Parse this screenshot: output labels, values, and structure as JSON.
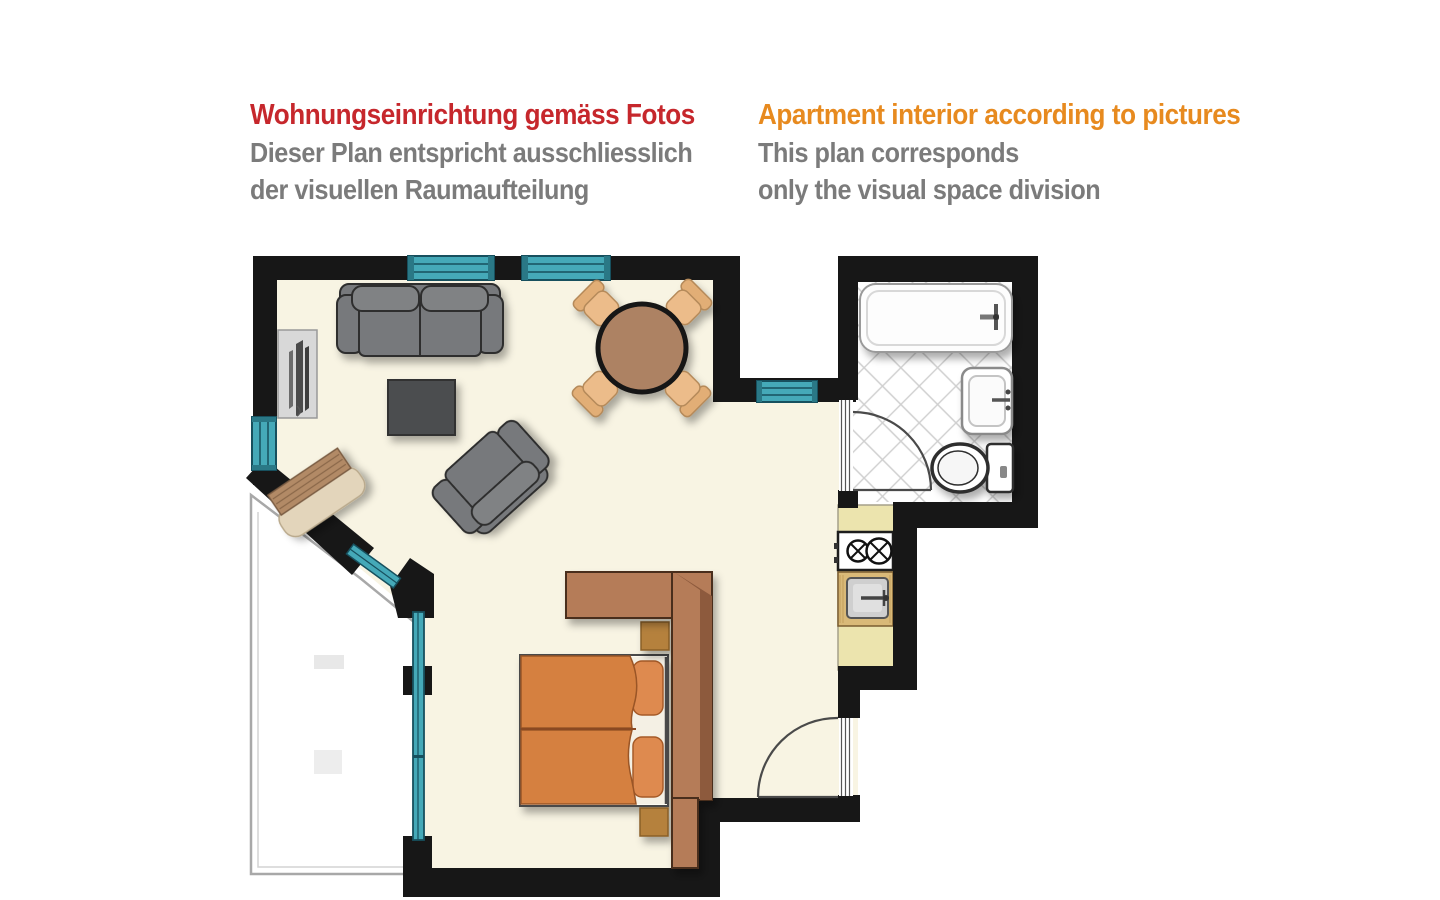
{
  "header": {
    "german": {
      "title": "Wohnungseinrichtung gemäss Fotos",
      "subtitle_line1": "Dieser Plan entspricht ausschliesslich",
      "subtitle_line2": "der visuellen Raumaufteilung",
      "title_color": "#c6272c",
      "subtitle_color": "#7b7b7b"
    },
    "english": {
      "title": "Apartment interior according to pictures",
      "subtitle_line1": "This plan corresponds",
      "subtitle_line2": "only the visual space division",
      "title_color": "#e78a1f",
      "subtitle_color": "#7b7b7b"
    }
  },
  "plan": {
    "colors": {
      "wall": "#171717",
      "floor": "#f8f4e3",
      "window": "#45a9b8",
      "window_frame": "#17505e",
      "balcony_border": "#a8a8a8",
      "sofa": "#77797b",
      "sofa_outline": "#2d2d2d",
      "coffee_table": "#4c4e50",
      "tv_panel": "#d8d8d8",
      "dining_table": "#ad8263",
      "chair": "#ecbc8a",
      "chair_back": "#e2ae76",
      "bench_seat": "#e3d5bb",
      "bench_back": "#b28a66",
      "bed_duvet": "#d5803f",
      "bed_pillow": "#de8a50",
      "bed_sheet": "#f4f0e4",
      "nightstand": "#b5813d",
      "wardrobe": "#b57c59",
      "wardrobe_edge": "#8d5a3c",
      "kitchen_counter": "#ece4ae",
      "kitchen_wood": "#d9b978",
      "sink_basin": "#cfcfcf",
      "tile_line": "#cfcfcf",
      "fixture_stroke": "#333333",
      "door_arc": "#4a4a4a"
    }
  }
}
